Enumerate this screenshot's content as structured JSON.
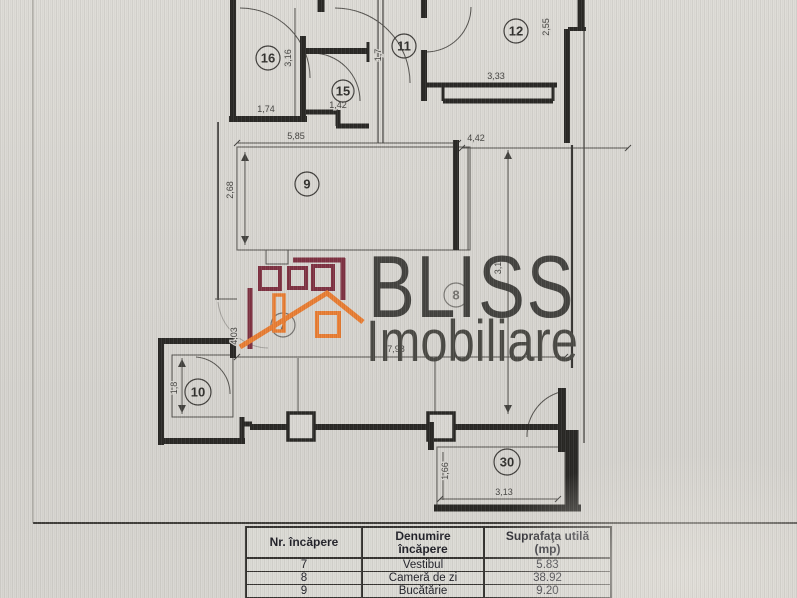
{
  "brand": {
    "name": "BLISS",
    "subtitle": "Imobiliare",
    "maroon": "#7b2c3d",
    "orange": "#e87a2e",
    "text_color": "#3e3d3a"
  },
  "plan": {
    "rooms": {
      "r16": "16",
      "r15": "15",
      "r11": "11",
      "r12": "12",
      "r9": "9",
      "r7": "7",
      "r8": "8",
      "r10": "10",
      "r30": "30"
    },
    "dims": {
      "d316": "3,16",
      "d174": "1,74",
      "d142": "1,42",
      "d17": "1,7",
      "d333": "3,33",
      "d255": "2,55",
      "d585": "5,85",
      "d442": "4,42",
      "d268": "2,68",
      "d31": "3,1",
      "d403": "4,03",
      "d798": "7,98",
      "d18": "1,8",
      "d313": "3,13",
      "d166": "1,66"
    }
  },
  "table": {
    "headers": {
      "col1": "Nr. încăpere",
      "col2_line1": "Denumire",
      "col2_line2": "încăpere",
      "col3_line1": "Suprafaţa utilă",
      "col3_line2": "(mp)"
    },
    "rows": [
      {
        "nr": "7",
        "name": "Vestibul",
        "area": "5.83"
      },
      {
        "nr": "8",
        "name": "Cameră de zi",
        "area": "38.92"
      },
      {
        "nr": "9",
        "name": "Bucătărie",
        "area": "9.20"
      }
    ]
  }
}
